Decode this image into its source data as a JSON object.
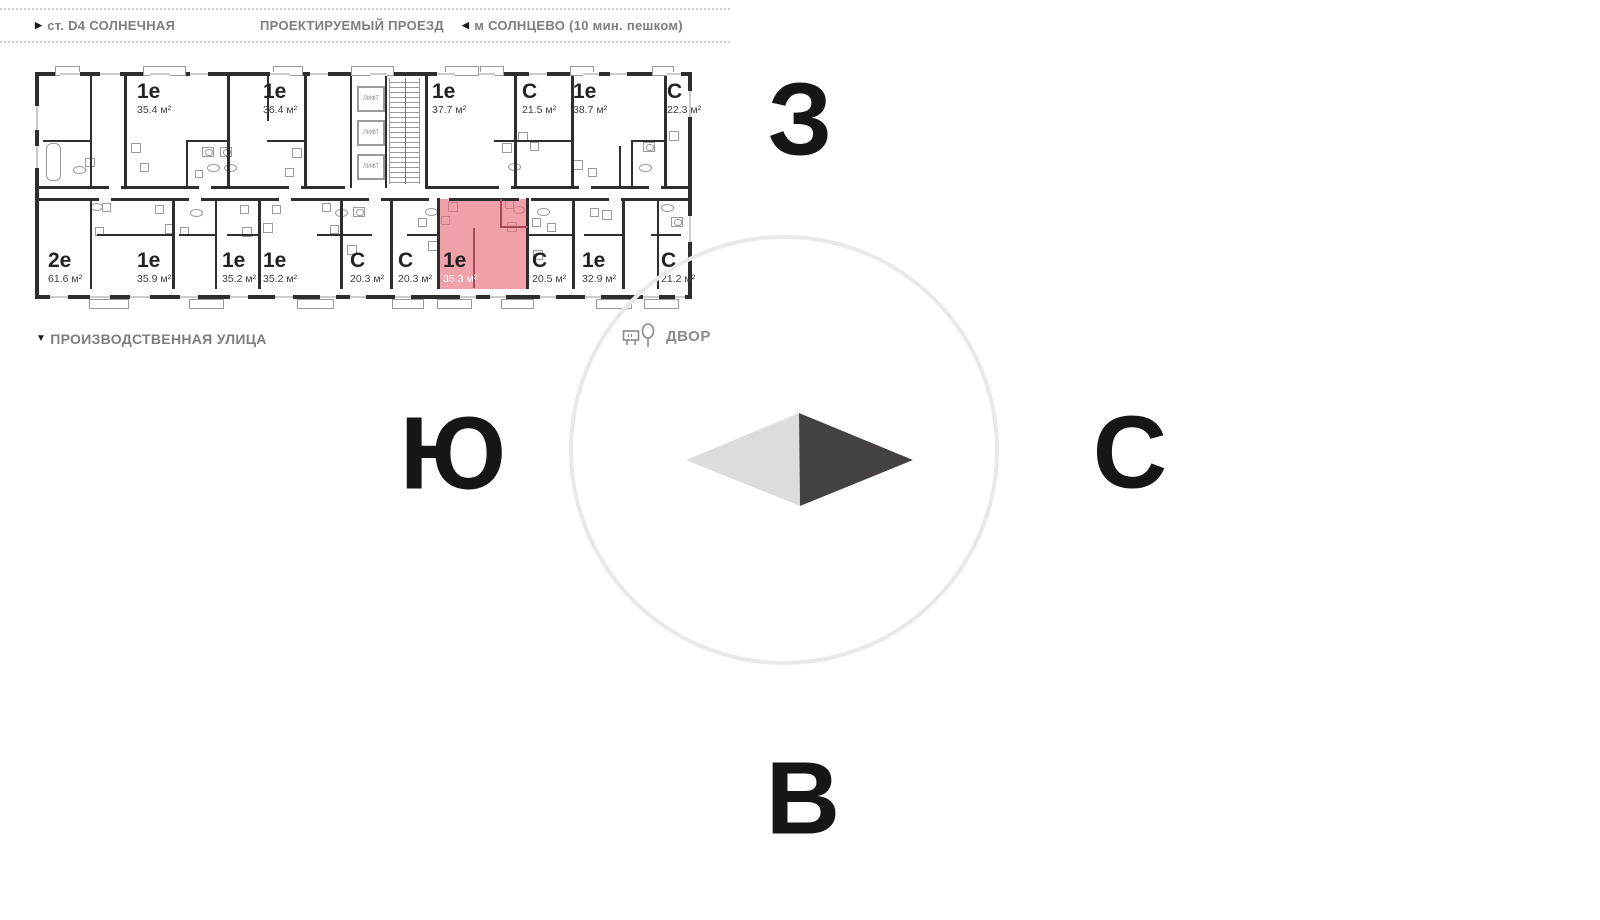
{
  "header": {
    "street_left": {
      "arrow": "▶",
      "label": "ст. D4 СОЛНЕЧНАЯ"
    },
    "street_center": {
      "label": "ПРОЕКТИРУЕМЫЙ ПРОЕЗД"
    },
    "street_right": {
      "arrow": "◀",
      "label": "м СОЛНЦЕВО (10 мин. пешком)"
    }
  },
  "street_bottom": {
    "arrow": "▼",
    "label": "ПРОИЗВОДСТВЕННАЯ УЛИЦА"
  },
  "courtyard": {
    "label": "ДВОР",
    "icon": "bench-and-tree-icon"
  },
  "elevator_label": "ЛИФТ",
  "compass": {
    "west": "З",
    "south": "Ю",
    "north": "С",
    "east": "В"
  },
  "plan": {
    "top_units": [
      {
        "type": "1е",
        "area": "35.4 м²"
      },
      {
        "type": "1е",
        "area": "36.4 м²"
      },
      {
        "type": "1е",
        "area": "37.7 м²"
      },
      {
        "type": "С",
        "area": "21.5 м²"
      },
      {
        "type": "1е",
        "area": "38.7 м²"
      },
      {
        "type": "С",
        "area": "22.3 м²"
      }
    ],
    "bottom_units": [
      {
        "type": "2е",
        "area": "61.6 м²"
      },
      {
        "type": "1е",
        "area": "35.9 м²"
      },
      {
        "type": "1е",
        "area": "35.2 м²"
      },
      {
        "type": "1е",
        "area": "35.2 м²"
      },
      {
        "type": "С",
        "area": "20.3 м²"
      },
      {
        "type": "С",
        "area": "20.3 м²"
      },
      {
        "type": "1е",
        "area": "35.3 м²",
        "highlighted": true
      },
      {
        "type": "С",
        "area": "20.5 м²"
      },
      {
        "type": "1е",
        "area": "32.9 м²"
      },
      {
        "type": "С",
        "area": "21.2 м²"
      }
    ]
  },
  "colors": {
    "wall": "#2e2e2e",
    "highlight_fill": "#f0a0a8",
    "highlight_wall": "#a84a55",
    "fixture_gray": "#9a9a9a",
    "fixture_pink": "#c8808a",
    "circle_stroke": "#e9e9e9",
    "arrow_light": "#dcdcdc",
    "arrow_dark": "#454140"
  }
}
